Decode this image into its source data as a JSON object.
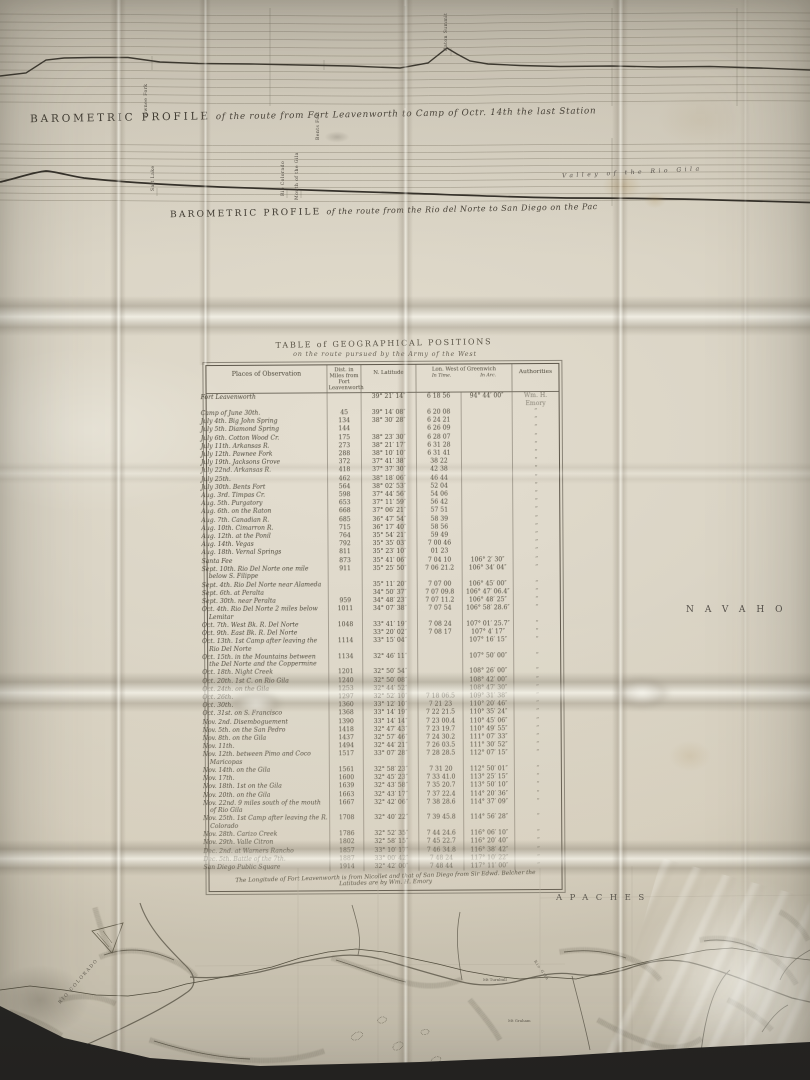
{
  "photo": {
    "paper_color": "#dbd5c6",
    "ink_color": "#443f36",
    "background_color": "#2c2b28"
  },
  "profiles": [
    {
      "title": "BAROMETRIC PROFILE",
      "subtitle": "of the route from Fort Leavenworth to Camp of Octr. 14th the last Station",
      "stations": [
        "Pawnee Fork",
        "Bents Fort",
        "Raton Summit"
      ]
    },
    {
      "title": "BAROMETRIC PROFILE",
      "subtitle": "of the route from the Rio del Norte to San Diego on the Pac",
      "stations": [
        "Salt Lake",
        "Rio Colorado",
        "Mouth of the Gila"
      ],
      "valley_label": "Valley of the Rio Gila"
    }
  ],
  "table": {
    "title_line1": "TABLE of GEOGRAPHICAL POSITIONS",
    "title_line2": "on the route pursued by the Army of the West",
    "headers": {
      "places": "Places of Observation",
      "dist": "Dist. in Miles from Fort Leavenworth",
      "lat": "N. Latitude",
      "lon": "Lon. West of Greenwich",
      "lon_time": "In Time.",
      "lon_arc": "In Arc.",
      "auth": "Authorities"
    },
    "rows": [
      [
        "Fort Leavenworth",
        "",
        "39° 21′ 14″",
        "6 18 56",
        "94° 44′ 00″",
        "Wm. H. Emory"
      ],
      [
        "Camp of June 30th.",
        "45",
        "39° 14′ 08″",
        "6 20 08",
        "",
        "”"
      ],
      [
        "July 4th. Big John Spring",
        "134",
        "38° 30′ 28″",
        "6 24 21",
        "",
        "”"
      ],
      [
        "July 5th. Diamond Spring",
        "144",
        "",
        "6 26 09",
        "",
        "”"
      ],
      [
        "July 6th. Cotton Wood Cr.",
        "175",
        "38° 23′ 30″",
        "6 28 07",
        "",
        "”"
      ],
      [
        "July 11th. Arkansas R.",
        "273",
        "38° 21′ 17″",
        "6 31 28",
        "",
        "”"
      ],
      [
        "July 12th. Pawnee Fork",
        "288",
        "38° 10′ 10″",
        "6 31 41",
        "",
        "”"
      ],
      [
        "July 19th. Jacksons Grove",
        "372",
        "37° 41′ 38″",
        "38 22",
        "",
        "”"
      ],
      [
        "July 22nd. Arkansas R.",
        "418",
        "37° 37′ 30″",
        "42 38",
        "",
        "”"
      ],
      [
        "July 25th.",
        "462",
        "38° 18′ 06″",
        "46 44",
        "",
        "”"
      ],
      [
        "July 30th. Bents Fort",
        "564",
        "38° 02′ 53″",
        "52 04",
        "",
        "”"
      ],
      [
        "Aug. 3rd. Timpas Cr.",
        "598",
        "37° 44′ 56″",
        "54 06",
        "",
        "”"
      ],
      [
        "Aug. 5th. Purgatory",
        "653",
        "37° 11′ 59″",
        "56 42",
        "",
        "”"
      ],
      [
        "Aug. 6th. on the Raton",
        "668",
        "37° 06′ 21″",
        "57 51",
        "",
        "”"
      ],
      [
        "Aug. 7th. Canadian R.",
        "685",
        "36° 47′ 54″",
        "58 39",
        "",
        "”"
      ],
      [
        "Aug. 10th. Cimarron R.",
        "715",
        "36° 17′ 40″",
        "58 56",
        "",
        "”"
      ],
      [
        "Aug. 12th. at the Ponil",
        "764",
        "35° 54′ 21″",
        "59 49",
        "",
        "”"
      ],
      [
        "Aug. 14th. Vegas",
        "792",
        "35° 35′ 03″",
        "7 00 46",
        "",
        "”"
      ],
      [
        "Aug. 18th. Vernal Springs",
        "811",
        "35° 23′ 10″",
        "01 23",
        "",
        "”"
      ],
      [
        "Santa Fee",
        "873",
        "35° 41′ 06″",
        "7 04 10",
        "106° 2′ 30″",
        "”"
      ],
      [
        "Sept. 10th. Rio Del Norte one mile below S. Filippe",
        "911",
        "35° 25′ 50″",
        "7 06 21.2",
        "106° 34′ 04″",
        "”"
      ],
      [
        "Sept. 4th. Rio Del Norte near Alameda",
        "",
        "35° 11′ 20″",
        "7 07 00",
        "106° 45′ 00″",
        "”"
      ],
      [
        "Sept. 6th. at Peralta",
        "",
        "34° 50′ 37″",
        "7 07 09.8",
        "106° 47′ 06.4″",
        "”"
      ],
      [
        "Sept. 30th. near Peralta",
        "959",
        "34° 48′ 23″",
        "7 07 11.2",
        "106° 48′ 25″",
        "”"
      ],
      [
        "Oct. 4th. Rio Del Norte 2 miles below Lemitar",
        "1011",
        "34° 07′ 38″",
        "7 07 54",
        "106° 58′ 28.6″",
        "”"
      ],
      [
        "Oct. 7th. West Bk. R. Del Norte",
        "1048",
        "33° 41′ 19″",
        "7 08 24",
        "107° 01′ 25.7″",
        "”"
      ],
      [
        "Oct. 9th. East Bk. R. Del Norte",
        "",
        "33° 20′ 02″",
        "7 08 17",
        "107° 4′ 17″",
        "”"
      ],
      [
        "Oct. 13th. 1st Camp after leaving the Rio Del Norte",
        "1114",
        "33° 15′ 04″",
        "",
        "107° 16′ 15″",
        "”"
      ],
      [
        "Oct. 15th. in the Mountains between the Del Norte and the Coppermine",
        "1134",
        "32° 46′ 11″",
        "",
        "107° 50′ 00″",
        "”"
      ],
      [
        "Oct. 18th. Night Creek",
        "1201",
        "32° 50′ 54″",
        "",
        "108° 26′ 00″",
        "”"
      ],
      [
        "Oct. 20th. 1st C. on Rio Gila",
        "1240",
        "32° 50′ 08″",
        "",
        "108° 42′ 00″",
        "”"
      ],
      [
        "Oct. 24th. on the Gila",
        "1253",
        "32° 44′ 52″",
        "",
        "108° 47′ 30″",
        "”"
      ],
      [
        "Oct. 26th.",
        "1297",
        "32° 52′ 10″",
        "7 18 06.5",
        "109° 31′ 38″",
        "”"
      ],
      [
        "Oct. 30th.",
        "1360",
        "33° 12′ 10″",
        "7 21 23",
        "110° 20′ 46″",
        "”"
      ],
      [
        "Oct. 31st. on S. Francisco",
        "1368",
        "33° 14′ 19″",
        "7 22 21.5",
        "110° 35′ 24″",
        "”"
      ],
      [
        "Nov. 2nd. Disemboguement",
        "1390",
        "33° 14′ 14″",
        "7 23 00.4",
        "110° 45′ 06″",
        "”"
      ],
      [
        "Nov. 5th. on the San Pedro",
        "1418",
        "32° 47′ 43″",
        "7 23 19.7",
        "110° 49′ 55″",
        "”"
      ],
      [
        "Nov. 8th. on the Gila",
        "1437",
        "32° 57′ 46″",
        "7 24 30.2",
        "111° 07′ 33″",
        "”"
      ],
      [
        "Nov. 11th.",
        "1494",
        "32° 44′ 21″",
        "7 26 03.5",
        "111° 30′ 52″",
        "”"
      ],
      [
        "Nov. 12th. between Pimo and Coco Maricopas",
        "1517",
        "33° 07′ 28″",
        "7 28 28.5",
        "112° 07′ 15″",
        "”"
      ],
      [
        "Nov. 14th. on the Gila",
        "1561",
        "32° 58′ 23″",
        "7 31 20",
        "112° 50′ 01″",
        "”"
      ],
      [
        "Nov. 17th.",
        "1600",
        "32° 45′ 23″",
        "7 33 41.0",
        "113° 25′ 15″",
        "”"
      ],
      [
        "Nov. 18th. 1st on the Gila",
        "1639",
        "32° 43′ 58″",
        "7 35 20.7",
        "113° 50′ 10″",
        "”"
      ],
      [
        "Nov. 20th. on the Gila",
        "1663",
        "32° 43′ 17″",
        "7 37 22.4",
        "114° 20′ 36″",
        "”"
      ],
      [
        "Nov. 22nd. 9 miles south of the mouth of Rio Gila",
        "1667",
        "32° 42′ 06″",
        "7 38 28.6",
        "114° 37′ 09″",
        "”"
      ],
      [
        "Nov. 25th. 1st Camp after leaving the R. Colorado",
        "1708",
        "32° 40′ 22″",
        "7 39 45.8",
        "114° 56′ 28″",
        "”"
      ],
      [
        "Nov. 28th. Carizo Creek",
        "1786",
        "32° 52′ 35″",
        "7 44 24.6",
        "116° 06′ 10″",
        "”"
      ],
      [
        "Nov. 29th. Valle Citron",
        "1802",
        "32° 58′ 15″",
        "7 45 22.7",
        "116° 20′ 40″",
        "”"
      ],
      [
        "Dec. 2nd. at Warners Rancho",
        "1857",
        "33° 10′ 17″",
        "7 46 34.8",
        "116° 38′ 42″",
        "”"
      ],
      [
        "Dec. 5th. Battle of the 7th.",
        "1887",
        "33° 00′ 42″",
        "7 48 24",
        "117° 10′ 22″",
        "”"
      ],
      [
        "San Diego Public Square",
        "1914",
        "32° 42′ 00″",
        "7 48 44",
        "117° 11′ 00″",
        "”"
      ]
    ],
    "footnote": "The Longitude of Fort Leavenworth is from Nicollet and that of San Diego from Sir Edwd. Belcher  the Latitudes are by Wm. H. Emory"
  },
  "map": {
    "navaho": "NAVAHO",
    "apaches": "APACHES",
    "rio_colorado": "RIO COLORADO",
    "mt_turnbull": "Mt Turnbull",
    "mt_graham": "Mt Graham",
    "rio_gila": "Rio Gila"
  }
}
